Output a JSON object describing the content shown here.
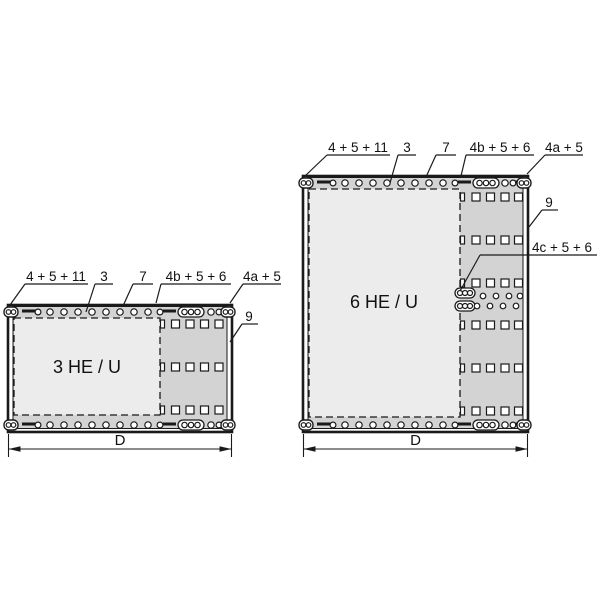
{
  "figure": {
    "width": 600,
    "height": 600,
    "background": "#ffffff"
  },
  "style": {
    "stroke_color": "#1a1a1a",
    "text_color": "#111111",
    "panel_fill": "#d3d3d3",
    "inner_fill": "#ececec",
    "hole_fill": "#ffffff",
    "label_font_size": 13.5,
    "title_font_size": 18,
    "dim_font_size": 15
  },
  "panels": [
    {
      "name": "panel-3he",
      "title": "3 HE / U",
      "frame": {
        "x": 8,
        "y": 305,
        "w": 224,
        "h": 127
      },
      "dashed_area": {
        "x": 14,
        "y": 318,
        "w": 146,
        "h": 97
      },
      "title_pos": {
        "x": 87,
        "y": 373
      },
      "edge_rows": [
        {
          "cy": 312
        },
        {
          "cy": 425
        }
      ],
      "edge": {
        "latch_left_x": 4,
        "latch_right_x": 221,
        "hook1": {
          "bar": [
            22,
            36
          ],
          "circle_x": 38
        },
        "circles_x": [
          50,
          64,
          78,
          92,
          106,
          120,
          134,
          148
        ],
        "hook2": {
          "circle_x": 160,
          "bar": [
            163,
            176
          ]
        },
        "gang_x": 178,
        "single_circle_x": 211,
        "hook3": {
          "circle_x": 219,
          "bar": [
            221,
            229
          ]
        },
        "circle_r": 3.2
      },
      "squares": {
        "rows_cy": [
          324,
          367,
          410
        ],
        "cols_cx": [
          175.5,
          190,
          204.5,
          219
        ],
        "partial_x": 160.5,
        "size": 8
      },
      "labels": [
        {
          "text": "4 + 5 + 11",
          "tx": 56,
          "ty": 281,
          "ul": [
            25,
            88,
            284
          ],
          "leader": [
            25,
            284,
            10,
            305
          ]
        },
        {
          "text": "3",
          "tx": 104,
          "ty": 281,
          "ul": [
            95,
            113,
            284
          ],
          "leader": [
            95,
            284,
            86,
            312
          ]
        },
        {
          "text": "7",
          "tx": 143,
          "ty": 281,
          "ul": [
            133,
            153,
            284
          ],
          "leader": [
            133,
            284,
            123,
            306
          ]
        },
        {
          "text": "4b + 5 + 6",
          "tx": 196,
          "ty": 281,
          "ul": [
            161,
            231,
            284
          ],
          "leader": [
            161,
            284,
            156,
            303
          ]
        },
        {
          "text": "4a + 5",
          "tx": 262,
          "ty": 281,
          "ul": [
            243,
            281,
            284
          ],
          "leader": [
            243,
            284,
            230,
            303
          ]
        },
        {
          "text": "9",
          "tx": 249,
          "ty": 321,
          "ul": [
            242,
            258,
            324
          ],
          "leader": [
            242,
            324,
            230,
            342
          ]
        }
      ],
      "dimension": {
        "label": "D",
        "x0": 8.5,
        "x1": 231.5,
        "line_y": 449,
        "ext_top": 434,
        "ext_bottom": 457,
        "label_x": 120,
        "label_y": 445
      }
    },
    {
      "name": "panel-6he",
      "title": "6 HE / U",
      "frame": {
        "x": 303,
        "y": 176,
        "w": 225,
        "h": 256
      },
      "dashed_area": {
        "x": 309,
        "y": 189,
        "w": 151,
        "h": 228
      },
      "title_pos": {
        "x": 384,
        "y": 308
      },
      "edge_rows": [
        {
          "cy": 183
        },
        {
          "cy": 425
        }
      ],
      "edge": {
        "latch_left_x": 299,
        "latch_right_x": 517,
        "hook1": {
          "bar": [
            317,
            331
          ],
          "circle_x": 333
        },
        "circles_x": [
          345,
          359,
          373,
          387,
          401,
          415,
          429,
          443
        ],
        "hook2": {
          "circle_x": 455,
          "bar": [
            458,
            471
          ]
        },
        "gang_x": 473,
        "single_circle_x": 505,
        "hook3": {
          "circle_x": 513,
          "bar": [
            515,
            523
          ]
        },
        "circle_r": 3.2
      },
      "squares": {
        "rows_cy": [
          197,
          240,
          283,
          325,
          368,
          411
        ],
        "cols_cx": [
          476,
          490.5,
          505,
          518.5
        ],
        "partial_x": 460.5,
        "size": 8
      },
      "cluster": {
        "gangs": [
          {
            "x": 455,
            "y": 288
          },
          {
            "x": 455,
            "y": 301
          }
        ],
        "dot_r": 2.8,
        "dots_top": {
          "y": 296,
          "x": [
            483,
            496,
            509,
            520
          ]
        },
        "dots_bottom": {
          "y": 306,
          "x": [
            477,
            490,
            503,
            516
          ]
        }
      },
      "labels": [
        {
          "text": "4 + 5 + 11",
          "tx": 358,
          "ty": 152,
          "ul": [
            327,
            390,
            155
          ],
          "leader": [
            327,
            155,
            305,
            176
          ]
        },
        {
          "text": "3",
          "tx": 407,
          "ty": 152,
          "ul": [
            398,
            416,
            155
          ],
          "leader": [
            398,
            155,
            390,
            183
          ]
        },
        {
          "text": "7",
          "tx": 446,
          "ty": 152,
          "ul": [
            436,
            456,
            155
          ],
          "leader": [
            436,
            155,
            426,
            177
          ]
        },
        {
          "text": "4b + 5 + 6",
          "tx": 500,
          "ty": 152,
          "ul": [
            466,
            534,
            155
          ],
          "leader": [
            466,
            155,
            461,
            176
          ]
        },
        {
          "text": "4a + 5",
          "tx": 564,
          "ty": 152,
          "ul": [
            545,
            583,
            155
          ],
          "leader": [
            545,
            155,
            527,
            174
          ]
        },
        {
          "text": "9",
          "tx": 549,
          "ty": 207,
          "ul": [
            542,
            558,
            210
          ],
          "leader": [
            542,
            210,
            529,
            227
          ]
        },
        {
          "text": "4c + 5 + 6",
          "tx": 562,
          "ty": 252,
          "ul": [
            480,
            597,
            255
          ],
          "leader": [
            480,
            255,
            460,
            291
          ]
        }
      ],
      "dimension": {
        "label": "D",
        "x0": 303.5,
        "x1": 527.5,
        "line_y": 449,
        "ext_top": 434,
        "ext_bottom": 457,
        "label_x": 415.5,
        "label_y": 445
      }
    }
  ]
}
